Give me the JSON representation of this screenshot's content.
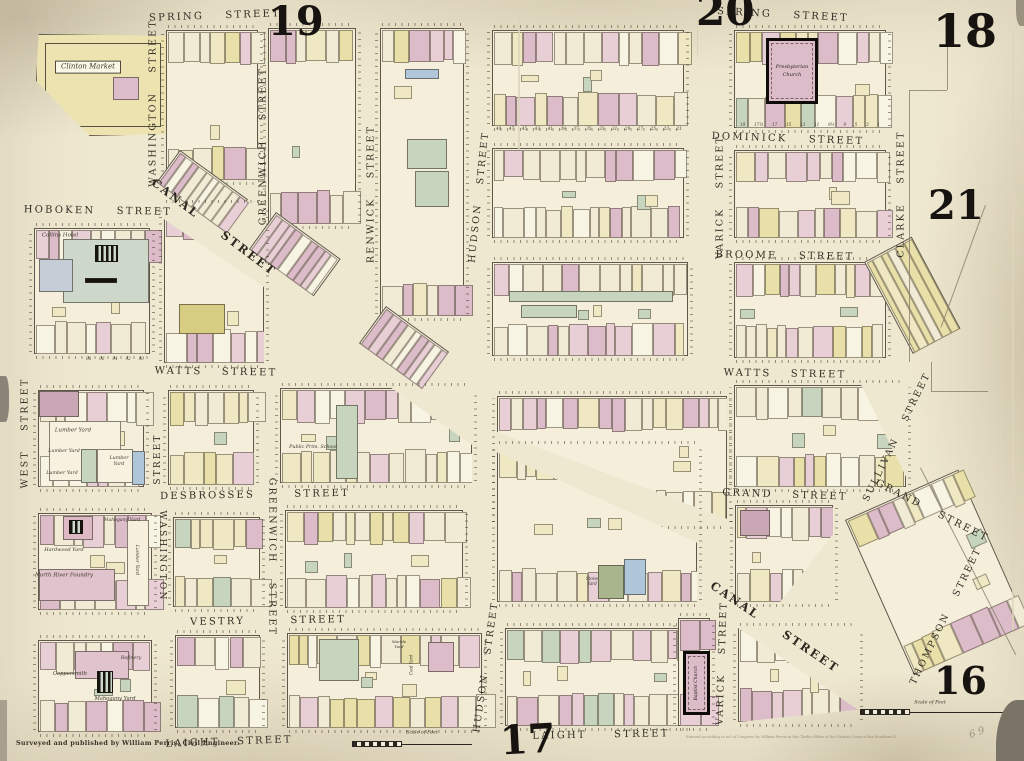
{
  "title": "Perris insurance atlas plate — Spring St / Canal St district, New York",
  "palette": {
    "P": "#dcbcc8",
    "p": "#e8cfd6",
    "C": "#f1ebd5",
    "Y": "#e8dfa9",
    "y": "#efe8c3",
    "G": "#c7d5bf",
    "B": "#aec6d8",
    "W": "#f8f4e3",
    "O": "#d6cc82"
  },
  "footer": {
    "credit": "Surveyed and published by William Perris, Civil Engineer.",
    "imprint": "Entered according to act of Congress by William Perris in the Clerk's Office of the District Court of the Southern District of New York."
  },
  "plate_numbers": [
    {
      "label": "19",
      "x": 268,
      "y": 2,
      "size": 40
    },
    {
      "label": "20",
      "x": 696,
      "y": -10,
      "size": 42
    },
    {
      "label": "18",
      "x": 933,
      "y": 8,
      "size": 46
    },
    {
      "label": "21",
      "x": 928,
      "y": 186,
      "size": 40
    },
    {
      "label": "16",
      "x": 934,
      "y": 662,
      "size": 38
    },
    {
      "label": "17",
      "x": 500,
      "y": 720,
      "size": 40,
      "rot": -3
    }
  ],
  "street_labels": [
    {
      "text": "SPRING STREET",
      "cx": 215,
      "cy": 16,
      "rot": -2,
      "size": 10,
      "ws": 16
    },
    {
      "text": "SPRING STREET",
      "cx": 783,
      "cy": 15,
      "rot": 3,
      "size": 10,
      "ws": 16
    },
    {
      "text": "WASHINGTON STREET",
      "cx": 153,
      "cy": 103,
      "rot": -90,
      "size": 9.5
    },
    {
      "text": "GREENWICH STREET",
      "cx": 263,
      "cy": 146,
      "rot": -90,
      "size": 9.5
    },
    {
      "text": "RENWICK STREET",
      "cx": 371,
      "cy": 194,
      "rot": -90,
      "size": 9.5
    },
    {
      "text": "HUDSON STREET",
      "cx": 479,
      "cy": 197,
      "rot": -84,
      "size": 9.5
    },
    {
      "text": "VARICK STREET",
      "cx": 720,
      "cy": 197,
      "rot": -90,
      "size": 9.5
    },
    {
      "text": "CLARKE STREET",
      "cx": 901,
      "cy": 194,
      "rot": -90,
      "size": 9.5
    },
    {
      "text": "HOBOKEN STREET",
      "cx": 98,
      "cy": 211,
      "rot": 1,
      "size": 10,
      "ws": 16
    },
    {
      "text": "CANAL STREET",
      "cx": 214,
      "cy": 227,
      "rot": 37,
      "size": 11.5,
      "ws": 24,
      "canal": true
    },
    {
      "text": "CANAL STREET",
      "cx": 775,
      "cy": 627,
      "rot": 34,
      "size": 11.5,
      "ws": 24,
      "canal": true
    },
    {
      "text": "DOMINICK STREET",
      "cx": 788,
      "cy": 139,
      "rot": 2,
      "size": 10,
      "ws": 16
    },
    {
      "text": "BROOME STREET",
      "cx": 785,
      "cy": 256,
      "rot": 1,
      "size": 10,
      "ws": 16
    },
    {
      "text": "WATTS STREET",
      "cx": 216,
      "cy": 372,
      "rot": 1,
      "size": 10,
      "ws": 14
    },
    {
      "text": "WATTS STREET",
      "cx": 785,
      "cy": 374,
      "rot": 1,
      "size": 10,
      "ws": 14
    },
    {
      "text": "GRAND STREET",
      "cx": 785,
      "cy": 495,
      "rot": 2,
      "size": 10,
      "ws": 14
    },
    {
      "text": "GRAND STREET",
      "cx": 932,
      "cy": 511,
      "rot": 27,
      "size": 10,
      "ws": 14
    },
    {
      "text": "SULLIVAN STREET",
      "cx": 897,
      "cy": 437,
      "rot": -64,
      "size": 9.5
    },
    {
      "text": "THOMPSON STREET",
      "cx": 946,
      "cy": 616,
      "rot": -64,
      "size": 9.5
    },
    {
      "text": "WEST STREET",
      "cx": 25,
      "cy": 433,
      "rot": -90,
      "size": 9.5
    },
    {
      "text": "STREET",
      "cx": 158,
      "cy": 459,
      "rot": -90,
      "size": 9
    },
    {
      "text": "WASHINGTON",
      "cx": 162,
      "cy": 556,
      "rot": 90,
      "size": 9
    },
    {
      "text": "GREENWICH STREET",
      "cx": 272,
      "cy": 557,
      "rot": 90,
      "size": 9.5
    },
    {
      "text": "DESBROSSES STREET",
      "cx": 255,
      "cy": 495,
      "rot": -1,
      "size": 10,
      "ws": 34
    },
    {
      "text": "VESTRY STREET",
      "cx": 268,
      "cy": 621,
      "rot": -1,
      "size": 10,
      "ws": 40
    },
    {
      "text": "LAIGHT STREET",
      "cx": 229,
      "cy": 742,
      "rot": -2,
      "size": 10,
      "ws": 12
    },
    {
      "text": "LAIGHT STREET",
      "cx": 601,
      "cy": 735,
      "rot": -1,
      "size": 10,
      "ws": 22
    },
    {
      "text": "HUDSON STREET",
      "cx": 486,
      "cy": 667,
      "rot": -82,
      "size": 9.5
    },
    {
      "text": "VARICK STREET",
      "cx": 722,
      "cy": 663,
      "rot": -88,
      "size": 9.5
    }
  ],
  "landmarks": [
    {
      "text": "Clinton Market",
      "cx": 88,
      "cy": 67,
      "size": 7,
      "boxed": true
    },
    {
      "text": "Collins Hotel",
      "cx": 60,
      "cy": 236,
      "size": 5.5
    },
    {
      "text": "Lumber Yard",
      "cx": 73,
      "cy": 431,
      "size": 5.5
    },
    {
      "text": "Lumber Yard",
      "cx": 64,
      "cy": 452,
      "size": 4.8
    },
    {
      "text": "Lumber Yard",
      "cx": 62,
      "cy": 474,
      "size": 4.8
    },
    {
      "text": "Lumber\nYard",
      "cx": 119,
      "cy": 462,
      "size": 4.8
    },
    {
      "text": "Public Prim. School",
      "cx": 313,
      "cy": 448,
      "size": 4.8
    },
    {
      "text": "Mahogany Yard",
      "cx": 122,
      "cy": 521,
      "size": 4.6
    },
    {
      "text": "Hardwood Yard",
      "cx": 64,
      "cy": 550,
      "size": 5
    },
    {
      "text": "North River Foundry",
      "cx": 64,
      "cy": 576,
      "size": 5.5
    },
    {
      "text": "Lumber Yard",
      "cx": 136,
      "cy": 560,
      "rot": 90,
      "size": 4.6
    },
    {
      "text": "Refinery",
      "cx": 131,
      "cy": 659,
      "size": 4.8
    },
    {
      "text": "Coppersmith",
      "cx": 70,
      "cy": 674,
      "size": 5.2
    },
    {
      "text": "Mahogany Yard",
      "cx": 115,
      "cy": 699,
      "size": 5.2
    },
    {
      "text": "Stone\nYard",
      "cx": 592,
      "cy": 581,
      "size": 4.2
    },
    {
      "text": "Marble\nYard",
      "cx": 399,
      "cy": 644,
      "size": 4
    },
    {
      "text": "Coal Yard",
      "cx": 411,
      "cy": 665,
      "rot": -90,
      "size": 4.2
    }
  ],
  "churches": [
    {
      "name": "presbyterian-church",
      "label": "Presbyterian\nChurch",
      "x": 766,
      "y": 38,
      "w": 52,
      "h": 66,
      "vertical": false,
      "size": 5
    },
    {
      "name": "baptist-church",
      "label": "Baptist Church",
      "x": 683,
      "y": 651,
      "w": 27,
      "h": 64,
      "vertical": true,
      "size": 4.5
    }
  ],
  "number_rows": [
    {
      "x": 496,
      "y": 126,
      "w": 186,
      "values": [
        "49",
        "47",
        "45",
        "43",
        "41",
        "39",
        "37",
        "35",
        "33",
        "31",
        "29",
        "27",
        "25",
        "23",
        "21"
      ]
    },
    {
      "x": 740,
      "y": 122,
      "w": 140,
      "values": [
        "19",
        "17½",
        "17",
        "15",
        "13",
        "11",
        "9½",
        "9",
        "5",
        "3",
        "1"
      ]
    },
    {
      "x": 86,
      "y": 356,
      "w": 58,
      "values": [
        "98",
        "96",
        "94",
        "92",
        "90"
      ]
    }
  ],
  "scale_bars": [
    {
      "label": "Scale of Feet",
      "x": 352,
      "y": 742,
      "w": 120,
      "lx": 422,
      "ly": 733
    },
    {
      "label": "Scale of Feet",
      "x": 860,
      "y": 710,
      "w": 146,
      "lx": 930,
      "ly": 703
    }
  ],
  "annotations": [
    {
      "text": "6 9",
      "cx": 977,
      "cy": 733,
      "rot": -20,
      "size": 10
    }
  ],
  "boundary_lines": [
    {
      "x": 909,
      "y": 90,
      "w": 0.8,
      "h": 272
    },
    {
      "x": 909,
      "y": 90,
      "w": 38,
      "h": 0.8
    },
    {
      "x": 947,
      "y": 18,
      "w": 0.8,
      "h": 72
    },
    {
      "x": 931,
      "y": 362,
      "w": 0.8,
      "h": 30
    },
    {
      "x": 931,
      "y": 391,
      "w": 57,
      "h": 0.8
    },
    {
      "x": 985,
      "y": 205,
      "w": 0.8,
      "h": 130,
      "rot": 20
    },
    {
      "x": 920,
      "y": 468,
      "w": 0.8,
      "h": 210,
      "rot": -27
    }
  ],
  "blocks": [
    {
      "id": "clinton-market-block",
      "x": 36,
      "y": 34,
      "w": 134,
      "h": 102,
      "kind": "plain",
      "bg": "#ece3b0",
      "clip": "polygon(2% 0%, 100% 2%, 100% 98%, 40% 100%, 0% 46%)",
      "overlays": [
        {
          "x": 8,
          "y": 8,
          "w": 116,
          "h": 84,
          "outline": true
        },
        {
          "x": 76,
          "y": 42,
          "w": 26,
          "h": 23,
          "c": "#dcbcc8"
        }
      ]
    },
    {
      "id": "spring-washington",
      "x": 166,
      "y": 30,
      "w": 92,
      "h": 150,
      "kind": "mosaic",
      "seed": 11,
      "weights": "PPpCCYyW"
    },
    {
      "id": "canal-fan-a",
      "x": 180,
      "y": 150,
      "w": 84,
      "h": 40,
      "rot": 36,
      "kind": "strip",
      "seed": 12,
      "weights": "PpCCW"
    },
    {
      "id": "spring-greenwich",
      "x": 268,
      "y": 28,
      "w": 88,
      "h": 196,
      "kind": "mosaic",
      "seed": 13,
      "weights": "PpCCYyW"
    },
    {
      "id": "canal-fan-b",
      "x": 276,
      "y": 212,
      "w": 80,
      "h": 46,
      "rot": 36,
      "kind": "strip",
      "seed": 14,
      "weights": "PpCW"
    },
    {
      "id": "spring-renwick",
      "x": 380,
      "y": 28,
      "w": 84,
      "h": 288,
      "kind": "mosaic",
      "seed": 15,
      "weights": "PpCYyW",
      "overlays": [
        {
          "x": 24,
          "y": 40,
          "w": 34,
          "h": 10,
          "c": "#aec6d8"
        },
        {
          "x": 26,
          "y": 110,
          "w": 40,
          "h": 30,
          "c": "#c7d5bf"
        },
        {
          "x": 34,
          "y": 142,
          "w": 34,
          "h": 36,
          "c": "#c7d5bf"
        }
      ]
    },
    {
      "id": "canal-fan-c",
      "x": 386,
      "y": 306,
      "w": 78,
      "h": 46,
      "rot": 36,
      "kind": "strip",
      "seed": 16,
      "weights": "PpCW"
    },
    {
      "id": "spring-hudson-varick",
      "x": 492,
      "y": 30,
      "w": 192,
      "h": 96,
      "kind": "mosaic",
      "seed": 17,
      "weights": "PPpCCyW"
    },
    {
      "id": "spring-varick-clarke",
      "x": 734,
      "y": 30,
      "w": 152,
      "h": 98,
      "kind": "mosaic",
      "seed": 18,
      "weights": "PpCCYyGW"
    },
    {
      "id": "dominick-h-v",
      "x": 492,
      "y": 148,
      "w": 192,
      "h": 90,
      "kind": "mosaic",
      "seed": 19,
      "weights": "PpCCyW"
    },
    {
      "id": "dominick-v-c",
      "x": 734,
      "y": 150,
      "w": 152,
      "h": 88,
      "kind": "mosaic",
      "seed": 20,
      "weights": "PpCCyYW"
    },
    {
      "id": "broome-h-v",
      "x": 492,
      "y": 262,
      "w": 196,
      "h": 94,
      "kind": "mosaic",
      "seed": 21,
      "weights": "PpCCyW",
      "overlays": [
        {
          "x": 16,
          "y": 28,
          "w": 164,
          "h": 11,
          "c": "#c7d5bf"
        },
        {
          "x": 28,
          "y": 42,
          "w": 56,
          "h": 13,
          "c": "#c7d5bf"
        }
      ]
    },
    {
      "id": "broome-varick",
      "x": 734,
      "y": 262,
      "w": 152,
      "h": 96,
      "kind": "mosaic",
      "seed": 22,
      "weights": "PpCCyYW"
    },
    {
      "id": "sullivan-fan",
      "x": 864,
      "y": 262,
      "w": 54,
      "h": 104,
      "rot": -28,
      "kind": "strip",
      "seed": 23,
      "weights": "YyYC"
    },
    {
      "id": "hoboken-block",
      "x": 34,
      "y": 228,
      "w": 116,
      "h": 126,
      "kind": "mosaic",
      "seed": 24,
      "weights": "PpCCW",
      "overlays": [
        {
          "x": 28,
          "y": 10,
          "w": 86,
          "h": 64,
          "c": "#cdd7ca"
        },
        {
          "x": 4,
          "y": 30,
          "w": 34,
          "h": 33,
          "c": "#c5ced6"
        },
        {
          "x": 60,
          "y": 16,
          "w": 23,
          "h": 17,
          "hatch": true
        },
        {
          "x": 50,
          "y": 49,
          "w": 32,
          "h": 5,
          "c": "#15110d"
        }
      ]
    },
    {
      "id": "canal-watts-wedge",
      "x": 164,
      "y": 205,
      "w": 100,
      "h": 158,
      "kind": "mosaic",
      "seed": 25,
      "weights": "PPpCW",
      "clip": "polygon(0% 9%, 100% 52%, 100% 100%, 0% 100%)",
      "overlays": [
        {
          "x": 14,
          "y": 98,
          "w": 46,
          "h": 30,
          "c": "#d6cc82"
        }
      ]
    },
    {
      "id": "lumber-yard-block",
      "x": 38,
      "y": 390,
      "w": 106,
      "h": 97,
      "kind": "mosaic",
      "seed": 26,
      "weights": "pCCWW",
      "overlays": [
        {
          "x": 0,
          "y": 0,
          "w": 40,
          "h": 26,
          "c": "#c9a7b4"
        },
        {
          "x": 10,
          "y": 30,
          "w": 72,
          "h": 60,
          "c": "#f7f2df"
        },
        {
          "x": 42,
          "y": 58,
          "w": 16,
          "h": 34,
          "c": "#c7d5bf"
        },
        {
          "x": 58,
          "y": 58,
          "w": 36,
          "h": 34,
          "c": "#f7f2df"
        },
        {
          "x": 93,
          "y": 60,
          "w": 13,
          "h": 34,
          "c": "#aec6d8"
        }
      ]
    },
    {
      "id": "watts-washington",
      "x": 168,
      "y": 390,
      "w": 86,
      "h": 95,
      "kind": "mosaic",
      "seed": 27,
      "weights": "YyyCCpW"
    },
    {
      "id": "school-block",
      "x": 280,
      "y": 388,
      "w": 192,
      "h": 95,
      "kind": "mosaic",
      "seed": 28,
      "weights": "PpCCyW",
      "clip": "polygon(0% 0%, 58% 0%, 100% 60%, 100% 100%, 0% 100%)",
      "overlays": [
        {
          "x": 55,
          "y": 16,
          "w": 22,
          "h": 74,
          "c": "#c7d5bf"
        }
      ]
    },
    {
      "id": "watts-canal-upper",
      "x": 497,
      "y": 396,
      "w": 230,
      "h": 128,
      "kind": "mosaic",
      "seed": 29,
      "weights": "PpCCyW",
      "clip": "polygon(0% 0%, 100% 0%, 100% 96%, 0% 28%)"
    },
    {
      "id": "watts-grand-right",
      "x": 734,
      "y": 385,
      "w": 172,
      "h": 102,
      "kind": "mosaic",
      "seed": 30,
      "weights": "YyCCpPGW",
      "clip": "polygon(0% 0%, 74% 0%, 100% 90%, 100% 100%, 0% 100%)"
    },
    {
      "id": "canal-vestry-lower",
      "x": 497,
      "y": 446,
      "w": 200,
      "h": 156,
      "kind": "mosaic",
      "seed": 31,
      "weights": "PpCCyW",
      "clip": "polygon(0% 4%, 100% 62%, 100% 100%, 0% 100%)",
      "overlays": [
        {
          "x": 100,
          "y": 118,
          "w": 26,
          "h": 34,
          "c": "#a9b68d"
        },
        {
          "x": 126,
          "y": 112,
          "w": 22,
          "h": 36,
          "c": "#aec6d8"
        }
      ]
    },
    {
      "id": "foundry-block",
      "x": 38,
      "y": 513,
      "w": 114,
      "h": 97,
      "kind": "mosaic",
      "seed": 32,
      "weights": "pPCCW",
      "overlays": [
        {
          "x": 24,
          "y": 2,
          "w": 30,
          "h": 24,
          "c": "#ddb9c6"
        },
        {
          "x": 30,
          "y": 6,
          "w": 14,
          "h": 14,
          "hatch": true
        },
        {
          "x": 0,
          "y": 55,
          "w": 76,
          "h": 32,
          "c": "#e0c3cd"
        },
        {
          "x": 88,
          "y": 6,
          "w": 22,
          "h": 86,
          "c": "#f6f0dc"
        }
      ]
    },
    {
      "id": "desbrosses-washington",
      "x": 173,
      "y": 517,
      "w": 87,
      "h": 90,
      "kind": "mosaic",
      "seed": 33,
      "weights": "PpCCGyW"
    },
    {
      "id": "desbrosses-greenwich",
      "x": 285,
      "y": 510,
      "w": 178,
      "h": 98,
      "kind": "mosaic",
      "seed": 34,
      "weights": "yYCCpPW"
    },
    {
      "id": "grand-canal-block",
      "x": 735,
      "y": 505,
      "w": 98,
      "h": 97,
      "kind": "mosaic",
      "seed": 35,
      "weights": "PpCCyW",
      "clip": "polygon(0% 0%, 100% 0%, 100% 30%, 46% 100%, 0% 100%)",
      "overlays": [
        {
          "x": 4,
          "y": 4,
          "w": 30,
          "h": 26,
          "c": "#c9a7b4"
        }
      ]
    },
    {
      "id": "thompson-block",
      "x": 845,
      "y": 520,
      "w": 124,
      "h": 170,
      "rot": -24,
      "kind": "mosaic",
      "seed": 36,
      "weights": "yYCCpPW"
    },
    {
      "id": "coppersmith-block",
      "x": 38,
      "y": 640,
      "w": 114,
      "h": 92,
      "kind": "mosaic",
      "seed": 37,
      "weights": "pPCCW",
      "overlays": [
        {
          "x": 36,
          "y": 10,
          "w": 54,
          "h": 28,
          "c": "#e0c3cd"
        },
        {
          "x": 58,
          "y": 30,
          "w": 16,
          "h": 22,
          "hatch": true
        }
      ]
    },
    {
      "id": "vestry-block",
      "x": 175,
      "y": 635,
      "w": 85,
      "h": 93,
      "kind": "mosaic",
      "seed": 38,
      "weights": "PpCCGyW"
    },
    {
      "id": "vestry-greenwich",
      "x": 287,
      "y": 633,
      "w": 195,
      "h": 95,
      "kind": "mosaic",
      "seed": 39,
      "weights": "pCCYyW",
      "overlays": [
        {
          "x": 31,
          "y": 5,
          "w": 40,
          "h": 42,
          "c": "#c7d5bf"
        },
        {
          "x": 140,
          "y": 8,
          "w": 26,
          "h": 30,
          "c": "#dcbcc8"
        }
      ]
    },
    {
      "id": "laight-hudson-varick",
      "x": 505,
      "y": 628,
      "w": 190,
      "h": 98,
      "kind": "mosaic",
      "seed": 40,
      "weights": "GPpCCC"
    },
    {
      "id": "baptist-strip",
      "x": 678,
      "y": 618,
      "w": 32,
      "h": 108,
      "kind": "mosaic",
      "seed": 41,
      "weights": "pPC"
    },
    {
      "id": "varick-canal-triangle",
      "x": 738,
      "y": 628,
      "w": 120,
      "h": 94,
      "kind": "mosaic",
      "seed": 42,
      "weights": "PpCW",
      "clip": "polygon(0% 0%, 100% 87%, 0% 100%)"
    }
  ]
}
